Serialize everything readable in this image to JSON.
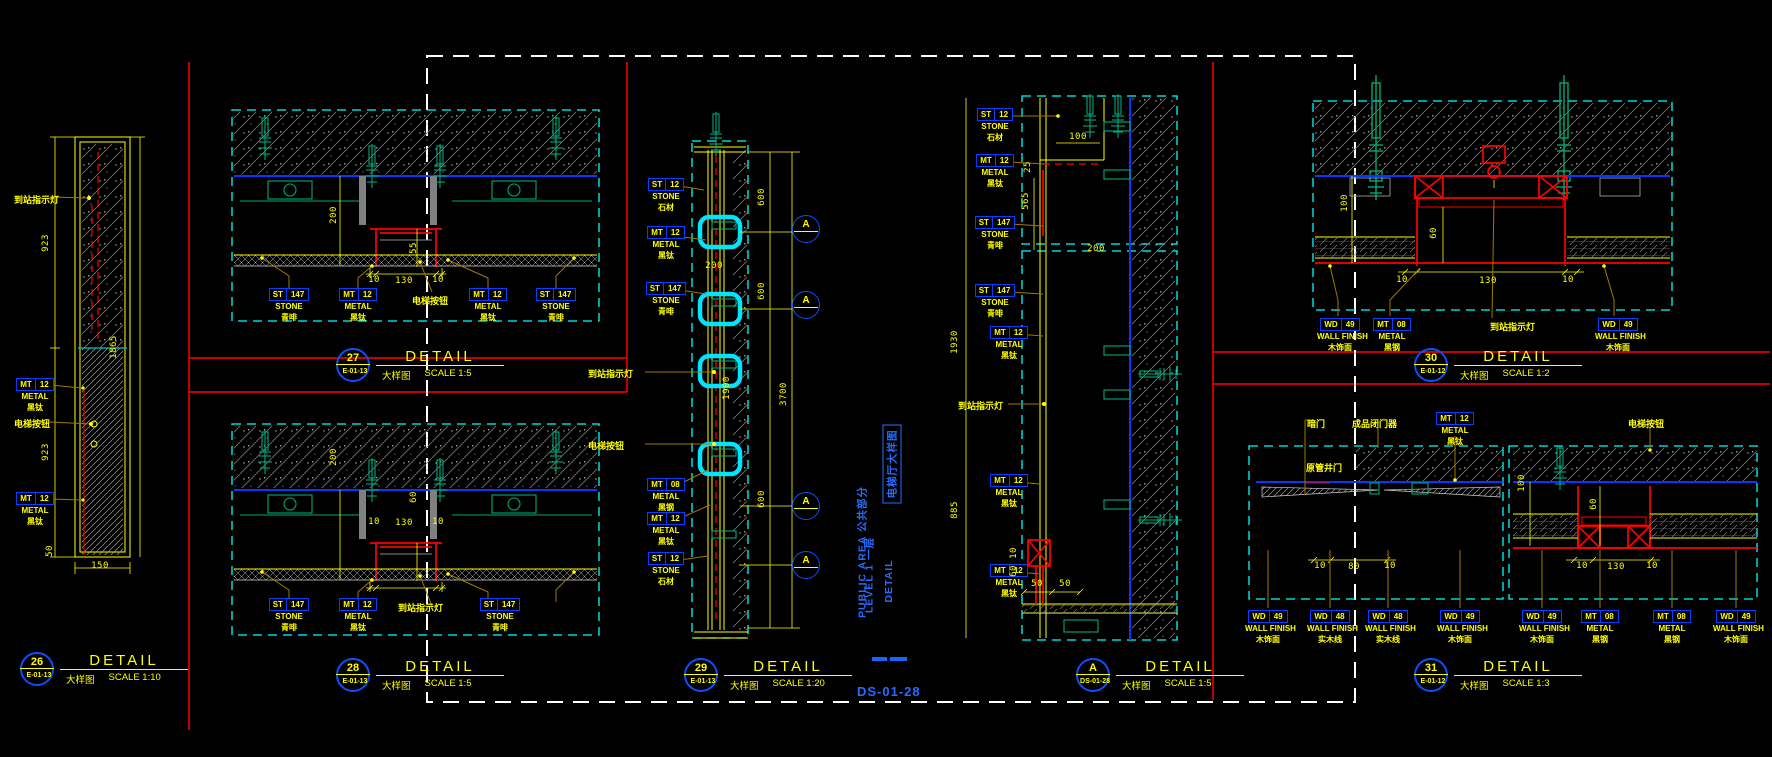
{
  "colors": {
    "background": "#000000",
    "yellow": "#ffff00",
    "cyan": "#00ffff",
    "blue_line": "#0238ff",
    "blue_box": "#0540ff",
    "blue_text": "#2a6bff",
    "red": "#ff0000",
    "green": "#00a878",
    "gray": "#8a8a8a",
    "leader_brown": "#a07800",
    "white": "#ffffff"
  },
  "sheet": {
    "number": "DS-01-28"
  },
  "titleblock": {
    "columns": [
      {
        "text": "PUBLIC AREA   公共部分",
        "x": 862,
        "y": 552,
        "boxed": false
      },
      {
        "text": "LEVEL 1   一层",
        "x": 869,
        "y": 575,
        "boxed": false
      },
      {
        "text": "DETAIL",
        "x": 889,
        "y": 581,
        "boxed": false
      },
      {
        "text": "电梯厅大样图",
        "x": 892,
        "y": 464,
        "boxed": true
      }
    ]
  },
  "detail_titles": [
    {
      "id": "26",
      "ref": "E-01-13",
      "name": "DETAIL",
      "sub": "大样图",
      "scale": "SCALE 1:10",
      "x": 20,
      "y": 652
    },
    {
      "id": "27",
      "ref": "E-01-13",
      "name": "DETAIL",
      "sub": "大样图",
      "scale": "SCALE 1:5",
      "x": 336,
      "y": 348
    },
    {
      "id": "28",
      "ref": "E-01-13",
      "name": "DETAIL",
      "sub": "大样图",
      "scale": "SCALE 1:5",
      "x": 336,
      "y": 658
    },
    {
      "id": "29",
      "ref": "E-01-13",
      "name": "DETAIL",
      "sub": "大样图",
      "scale": "SCALE 1:20",
      "x": 684,
      "y": 658
    },
    {
      "id": "A",
      "ref": "DS-01-28",
      "name": "DETAIL",
      "sub": "大样图",
      "scale": "SCALE 1:5",
      "x": 1076,
      "y": 658
    },
    {
      "id": "30",
      "ref": "E-01-12",
      "name": "DETAIL",
      "sub": "大样图",
      "scale": "SCALE 1:2",
      "x": 1414,
      "y": 348
    },
    {
      "id": "31",
      "ref": "E-01-12",
      "name": "DETAIL",
      "sub": "大样图",
      "scale": "SCALE 1:3",
      "x": 1414,
      "y": 658
    }
  ],
  "material_tags": [
    {
      "c1": "MT",
      "c2": "12",
      "l1": "METAL",
      "l2": "黑钛",
      "x": 12,
      "y": 378
    },
    {
      "c1": "MT",
      "c2": "12",
      "l1": "METAL",
      "l2": "黑钛",
      "x": 12,
      "y": 492
    },
    {
      "c1": "ST",
      "c2": "147",
      "l1": "STONE",
      "l2": "青啡",
      "x": 266,
      "y": 288
    },
    {
      "c1": "MT",
      "c2": "12",
      "l1": "METAL",
      "l2": "黑钛",
      "x": 335,
      "y": 288
    },
    {
      "c1": "MT",
      "c2": "12",
      "l1": "METAL",
      "l2": "黑钛",
      "x": 465,
      "y": 288
    },
    {
      "c1": "ST",
      "c2": "147",
      "l1": "STONE",
      "l2": "青啡",
      "x": 533,
      "y": 288
    },
    {
      "c1": "ST",
      "c2": "147",
      "l1": "STONE",
      "l2": "青啡",
      "x": 266,
      "y": 598
    },
    {
      "c1": "MT",
      "c2": "12",
      "l1": "METAL",
      "l2": "黑钛",
      "x": 335,
      "y": 598
    },
    {
      "c1": "ST",
      "c2": "147",
      "l1": "STONE",
      "l2": "青啡",
      "x": 477,
      "y": 598
    },
    {
      "c1": "ST",
      "c2": "12",
      "l1": "STONE",
      "l2": "石材",
      "x": 643,
      "y": 178
    },
    {
      "c1": "MT",
      "c2": "12",
      "l1": "METAL",
      "l2": "黑钛",
      "x": 643,
      "y": 226
    },
    {
      "c1": "ST",
      "c2": "147",
      "l1": "STONE",
      "l2": "青啡",
      "x": 643,
      "y": 282
    },
    {
      "c1": "MT",
      "c2": "08",
      "l1": "METAL",
      "l2": "黑钢",
      "x": 643,
      "y": 478
    },
    {
      "c1": "MT",
      "c2": "12",
      "l1": "METAL",
      "l2": "黑钛",
      "x": 643,
      "y": 512
    },
    {
      "c1": "ST",
      "c2": "12",
      "l1": "STONE",
      "l2": "石材",
      "x": 643,
      "y": 552
    },
    {
      "c1": "ST",
      "c2": "12",
      "l1": "STONE",
      "l2": "石材",
      "x": 972,
      "y": 108
    },
    {
      "c1": "MT",
      "c2": "12",
      "l1": "METAL",
      "l2": "黑钛",
      "x": 972,
      "y": 154
    },
    {
      "c1": "ST",
      "c2": "147",
      "l1": "STONE",
      "l2": "青啡",
      "x": 972,
      "y": 216
    },
    {
      "c1": "ST",
      "c2": "147",
      "l1": "STONE",
      "l2": "青啡",
      "x": 972,
      "y": 284
    },
    {
      "c1": "MT",
      "c2": "12",
      "l1": "METAL",
      "l2": "黑钛",
      "x": 986,
      "y": 326
    },
    {
      "c1": "MT",
      "c2": "12",
      "l1": "METAL",
      "l2": "黑钛",
      "x": 986,
      "y": 474
    },
    {
      "c1": "MT",
      "c2": "12",
      "l1": "METAL",
      "l2": "黑钛",
      "x": 986,
      "y": 564
    },
    {
      "c1": "WD",
      "c2": "49",
      "l1": "WALL FINISH",
      "l2": "木饰面",
      "x": 1317,
      "y": 318
    },
    {
      "c1": "MT",
      "c2": "08",
      "l1": "METAL",
      "l2": "黑钢",
      "x": 1369,
      "y": 318
    },
    {
      "c1": "WD",
      "c2": "49",
      "l1": "WALL FINISH",
      "l2": "木饰面",
      "x": 1595,
      "y": 318
    },
    {
      "c1": "MT",
      "c2": "12",
      "l1": "METAL",
      "l2": "黑钛",
      "x": 1432,
      "y": 412
    },
    {
      "c1": "WD",
      "c2": "49",
      "l1": "WALL FINISH",
      "l2": "木饰面",
      "x": 1245,
      "y": 610
    },
    {
      "c1": "WD",
      "c2": "48",
      "l1": "WALL FINISH",
      "l2": "实木线",
      "x": 1307,
      "y": 610
    },
    {
      "c1": "WD",
      "c2": "48",
      "l1": "WALL FINISH",
      "l2": "实木线",
      "x": 1365,
      "y": 610
    },
    {
      "c1": "WD",
      "c2": "49",
      "l1": "WALL FINISH",
      "l2": "木饰面",
      "x": 1437,
      "y": 610
    },
    {
      "c1": "WD",
      "c2": "49",
      "l1": "WALL FINISH",
      "l2": "木饰面",
      "x": 1519,
      "y": 610
    },
    {
      "c1": "MT",
      "c2": "08",
      "l1": "METAL",
      "l2": "黑钢",
      "x": 1577,
      "y": 610
    },
    {
      "c1": "MT",
      "c2": "08",
      "l1": "METAL",
      "l2": "黑钢",
      "x": 1649,
      "y": 610
    },
    {
      "c1": "WD",
      "c2": "49",
      "l1": "WALL FINISH",
      "l2": "木饰面",
      "x": 1713,
      "y": 610
    }
  ],
  "plain_labels": [
    {
      "text": "到站指示灯",
      "x": 14,
      "y": 193
    },
    {
      "text": "电梯按钮",
      "x": 14,
      "y": 417
    },
    {
      "text": "电梯按钮",
      "x": 412,
      "y": 294
    },
    {
      "text": "到站指示灯",
      "x": 398,
      "y": 601
    },
    {
      "text": "到站指示灯",
      "x": 588,
      "y": 367
    },
    {
      "text": "电梯按钮",
      "x": 588,
      "y": 439
    },
    {
      "text": "到站指示灯",
      "x": 958,
      "y": 399
    },
    {
      "text": "到站指示灯",
      "x": 1490,
      "y": 320
    },
    {
      "text": "暗门",
      "x": 1307,
      "y": 417
    },
    {
      "text": "成品闭门器",
      "x": 1352,
      "y": 417
    },
    {
      "text": "电梯按钮",
      "x": 1628,
      "y": 417
    },
    {
      "text": "原管井门",
      "x": 1306,
      "y": 461
    }
  ],
  "dimensions": [
    {
      "t": "923",
      "x": 46,
      "y": 243,
      "r": 1
    },
    {
      "t": "923",
      "x": 46,
      "y": 452,
      "r": 1
    },
    {
      "t": "1865",
      "x": 114,
      "y": 347,
      "r": 1
    },
    {
      "t": "150",
      "x": 100,
      "y": 566,
      "r": 0
    },
    {
      "t": "50",
      "x": 50,
      "y": 551,
      "r": 1
    },
    {
      "t": "200",
      "x": 334,
      "y": 215,
      "r": 1
    },
    {
      "t": "55",
      "x": 414,
      "y": 248,
      "r": 1
    },
    {
      "t": "10",
      "x": 374,
      "y": 280,
      "r": 0
    },
    {
      "t": "130",
      "x": 404,
      "y": 281,
      "r": 0
    },
    {
      "t": "10",
      "x": 438,
      "y": 280,
      "r": 0
    },
    {
      "t": "200",
      "x": 334,
      "y": 457,
      "r": 1
    },
    {
      "t": "60",
      "x": 414,
      "y": 497,
      "r": 1
    },
    {
      "t": "10",
      "x": 374,
      "y": 522,
      "r": 0
    },
    {
      "t": "130",
      "x": 404,
      "y": 523,
      "r": 0
    },
    {
      "t": "10",
      "x": 438,
      "y": 522,
      "r": 0
    },
    {
      "t": "200",
      "x": 714,
      "y": 266,
      "r": 0
    },
    {
      "t": "600",
      "x": 762,
      "y": 197,
      "r": 1
    },
    {
      "t": "600",
      "x": 762,
      "y": 291,
      "r": 1
    },
    {
      "t": "1900",
      "x": 727,
      "y": 388,
      "r": 1
    },
    {
      "t": "3700",
      "x": 784,
      "y": 394,
      "r": 1
    },
    {
      "t": "600",
      "x": 762,
      "y": 499,
      "r": 1
    },
    {
      "t": "100",
      "x": 1078,
      "y": 137,
      "r": 0
    },
    {
      "t": "25",
      "x": 1028,
      "y": 167,
      "r": 1
    },
    {
      "t": "565",
      "x": 1026,
      "y": 201,
      "r": 1
    },
    {
      "t": "200",
      "x": 1096,
      "y": 249,
      "r": 0
    },
    {
      "t": "1930",
      "x": 955,
      "y": 342,
      "r": 1
    },
    {
      "t": "885",
      "x": 955,
      "y": 510,
      "r": 1
    },
    {
      "t": "10",
      "x": 1014,
      "y": 553,
      "r": 1
    },
    {
      "t": "60",
      "x": 1014,
      "y": 571,
      "r": 1
    },
    {
      "t": "50",
      "x": 1037,
      "y": 584,
      "r": 0
    },
    {
      "t": "50",
      "x": 1065,
      "y": 584,
      "r": 0
    },
    {
      "t": "100",
      "x": 1345,
      "y": 203,
      "r": 1
    },
    {
      "t": "60",
      "x": 1434,
      "y": 233,
      "r": 1
    },
    {
      "t": "10",
      "x": 1402,
      "y": 280,
      "r": 0
    },
    {
      "t": "130",
      "x": 1488,
      "y": 281,
      "r": 0
    },
    {
      "t": "10",
      "x": 1568,
      "y": 280,
      "r": 0
    },
    {
      "t": "10",
      "x": 1320,
      "y": 566,
      "r": 0
    },
    {
      "t": "80",
      "x": 1354,
      "y": 567,
      "r": 0
    },
    {
      "t": "10",
      "x": 1390,
      "y": 566,
      "r": 0
    },
    {
      "t": "100",
      "x": 1522,
      "y": 483,
      "r": 1
    },
    {
      "t": "60",
      "x": 1594,
      "y": 504,
      "r": 1
    },
    {
      "t": "10",
      "x": 1582,
      "y": 566,
      "r": 0
    },
    {
      "t": "130",
      "x": 1616,
      "y": 567,
      "r": 0
    },
    {
      "t": "10",
      "x": 1652,
      "y": 566,
      "r": 0
    }
  ],
  "ref_circles": [
    {
      "label": "A",
      "x": 806,
      "y": 229
    },
    {
      "label": "A",
      "x": 806,
      "y": 305
    },
    {
      "label": "A",
      "x": 806,
      "y": 506
    },
    {
      "label": "A",
      "x": 806,
      "y": 565
    }
  ]
}
